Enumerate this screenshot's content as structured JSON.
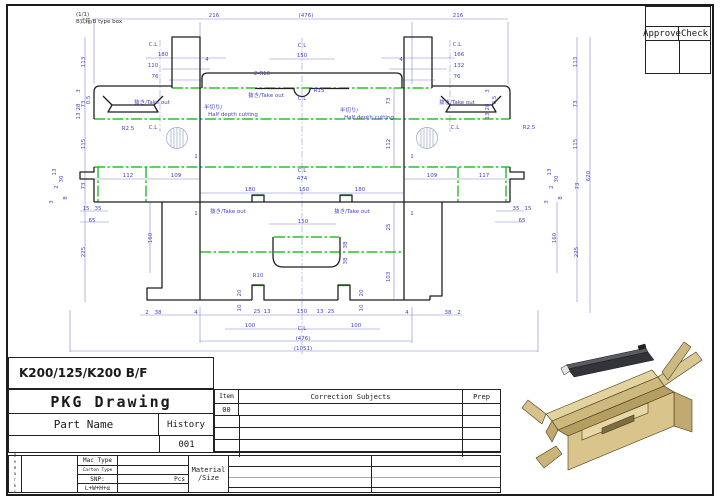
{
  "sheet": {
    "page_note": "(1/1)",
    "box_type": "B式箱/B type box",
    "part_label": "K200/125/K200 B/F"
  },
  "approval": {
    "approve": "Approve",
    "check": "Check"
  },
  "title_block": {
    "title": "PKG Drawing",
    "part_name": "Part Name",
    "history": "History",
    "history_no": "001",
    "item_label": "Item",
    "item_no": "00",
    "correction": "Correction Subjects",
    "prep": "Prep"
  },
  "spec_block": {
    "remarks": "Remarks",
    "mac_type": "Mac Type",
    "carton_type": "Carton Type",
    "snp": "SNP:",
    "pcs": "Pcs",
    "formula": "L+W+H+α",
    "material": "Material",
    "size": "/Size"
  },
  "colors": {
    "dimension": "#4545c8",
    "crease": "#00b400",
    "cut": "#1f1f1f",
    "carton": "#d9c48c"
  },
  "drawing": {
    "dims": [
      {
        "t": "(1/1)",
        "x": 76,
        "y": 16,
        "a": "s",
        "c": "k"
      },
      {
        "t": "B式箱/B type box",
        "x": 76,
        "y": 23,
        "a": "s",
        "c": "k"
      },
      {
        "t": "216",
        "x": 214,
        "y": 17
      },
      {
        "t": "(476)",
        "x": 306,
        "y": 17
      },
      {
        "t": "216",
        "x": 458,
        "y": 17
      },
      {
        "t": "C.L",
        "x": 153,
        "y": 46
      },
      {
        "t": "180",
        "x": 163,
        "y": 56
      },
      {
        "t": "110",
        "x": 153,
        "y": 67
      },
      {
        "t": "76",
        "x": 155,
        "y": 78
      },
      {
        "t": "4",
        "x": 207,
        "y": 61
      },
      {
        "t": "C.L",
        "x": 457,
        "y": 46
      },
      {
        "t": "166",
        "x": 459,
        "y": 56
      },
      {
        "t": "132",
        "x": 459,
        "y": 67
      },
      {
        "t": "76",
        "x": 457,
        "y": 78
      },
      {
        "t": "4",
        "x": 401,
        "y": 61
      },
      {
        "t": "C.L",
        "x": 302,
        "y": 47
      },
      {
        "t": "150",
        "x": 302,
        "y": 57
      },
      {
        "t": "2-R10",
        "x": 262,
        "y": 75
      },
      {
        "t": "R15",
        "x": 319,
        "y": 92
      },
      {
        "t": "C.L",
        "x": 302,
        "y": 100
      },
      {
        "t": "抜き/Take out",
        "x": 152,
        "y": 104
      },
      {
        "t": "抜き/Take out",
        "x": 266,
        "y": 97
      },
      {
        "t": "抜き/Take out",
        "x": 457,
        "y": 104
      },
      {
        "t": "半切り/",
        "x": 213,
        "y": 109
      },
      {
        "t": "Half depth cutting",
        "x": 233,
        "y": 116
      },
      {
        "t": "半切り/",
        "x": 349,
        "y": 112
      },
      {
        "t": "Half depth cutting",
        "x": 369,
        "y": 119
      },
      {
        "t": "R2.5",
        "x": 128,
        "y": 130
      },
      {
        "t": "C.L",
        "x": 153,
        "y": 129
      },
      {
        "t": "C.L",
        "x": 455,
        "y": 129
      },
      {
        "t": "R2.5",
        "x": 529,
        "y": 129
      },
      {
        "t": "3",
        "x": 80,
        "y": 91,
        "r": 1
      },
      {
        "t": "0.5",
        "x": 90,
        "y": 100,
        "r": 1
      },
      {
        "t": "28",
        "x": 80,
        "y": 107,
        "r": 1
      },
      {
        "t": "13",
        "x": 80,
        "y": 116,
        "r": 1
      },
      {
        "t": "3",
        "x": 489,
        "y": 91,
        "r": 1
      },
      {
        "t": "0.5",
        "x": 496,
        "y": 100,
        "r": 1
      },
      {
        "t": "28",
        "x": 489,
        "y": 107,
        "r": 1
      },
      {
        "t": "13",
        "x": 489,
        "y": 116,
        "r": 1
      },
      {
        "t": "113",
        "x": 85,
        "y": 62,
        "r": 1
      },
      {
        "t": "73",
        "x": 85,
        "y": 104,
        "r": 1
      },
      {
        "t": "115",
        "x": 85,
        "y": 144,
        "r": 1
      },
      {
        "t": "73",
        "x": 85,
        "y": 186,
        "r": 1
      },
      {
        "t": "225",
        "x": 85,
        "y": 252,
        "r": 1
      },
      {
        "t": "113",
        "x": 577,
        "y": 62,
        "r": 1
      },
      {
        "t": "73",
        "x": 577,
        "y": 104,
        "r": 1
      },
      {
        "t": "115",
        "x": 577,
        "y": 144,
        "r": 1
      },
      {
        "t": "73",
        "x": 579,
        "y": 186,
        "r": 1
      },
      {
        "t": "225",
        "x": 578,
        "y": 252,
        "r": 1
      },
      {
        "t": "620",
        "x": 590,
        "y": 176,
        "r": 1
      },
      {
        "t": "112",
        "x": 128,
        "y": 177
      },
      {
        "t": "109",
        "x": 176,
        "y": 177
      },
      {
        "t": "C.L",
        "x": 302,
        "y": 172
      },
      {
        "t": "474",
        "x": 302,
        "y": 180
      },
      {
        "t": "109",
        "x": 432,
        "y": 177
      },
      {
        "t": "117",
        "x": 484,
        "y": 177
      },
      {
        "t": "180",
        "x": 250,
        "y": 191
      },
      {
        "t": "150",
        "x": 304,
        "y": 191
      },
      {
        "t": "180",
        "x": 360,
        "y": 191
      },
      {
        "t": "1",
        "x": 196,
        "y": 158
      },
      {
        "t": "1",
        "x": 412,
        "y": 158
      },
      {
        "t": "1",
        "x": 196,
        "y": 215
      },
      {
        "t": "1",
        "x": 412,
        "y": 215
      },
      {
        "t": "73",
        "x": 390,
        "y": 101,
        "r": 1
      },
      {
        "t": "112",
        "x": 390,
        "y": 144,
        "r": 1
      },
      {
        "t": "25",
        "x": 390,
        "y": 227,
        "r": 1
      },
      {
        "t": "103",
        "x": 390,
        "y": 277,
        "r": 1
      },
      {
        "t": "抜き/Take out",
        "x": 228,
        "y": 213
      },
      {
        "t": "抜き/Take out",
        "x": 352,
        "y": 213
      },
      {
        "t": "150",
        "x": 303,
        "y": 223
      },
      {
        "t": "R10",
        "x": 258,
        "y": 277
      },
      {
        "t": "38",
        "x": 347,
        "y": 245,
        "r": 1
      },
      {
        "t": "38",
        "x": 347,
        "y": 261,
        "r": 1
      },
      {
        "t": "15",
        "x": 86,
        "y": 210
      },
      {
        "t": "35",
        "x": 98,
        "y": 210
      },
      {
        "t": "65",
        "x": 92,
        "y": 222
      },
      {
        "t": "35",
        "x": 516,
        "y": 210
      },
      {
        "t": "15",
        "x": 528,
        "y": 210
      },
      {
        "t": "65",
        "x": 522,
        "y": 222
      },
      {
        "t": "160",
        "x": 152,
        "y": 238,
        "r": 1
      },
      {
        "t": "160",
        "x": 556,
        "y": 238,
        "r": 1
      },
      {
        "t": "13",
        "x": 56,
        "y": 172,
        "r": 1
      },
      {
        "t": "30",
        "x": 63,
        "y": 179,
        "r": 1
      },
      {
        "t": "2",
        "x": 58,
        "y": 187,
        "r": 1
      },
      {
        "t": "8",
        "x": 67,
        "y": 198,
        "r": 1
      },
      {
        "t": "3",
        "x": 53,
        "y": 202,
        "r": 1
      },
      {
        "t": "13",
        "x": 551,
        "y": 172,
        "r": 1
      },
      {
        "t": "30",
        "x": 558,
        "y": 179,
        "r": 1
      },
      {
        "t": "2",
        "x": 553,
        "y": 187,
        "r": 1
      },
      {
        "t": "8",
        "x": 562,
        "y": 198,
        "r": 1
      },
      {
        "t": "3",
        "x": 548,
        "y": 202,
        "r": 1
      },
      {
        "t": "2",
        "x": 147,
        "y": 314
      },
      {
        "t": "38",
        "x": 158,
        "y": 314
      },
      {
        "t": "4",
        "x": 196,
        "y": 314
      },
      {
        "t": "25",
        "x": 257,
        "y": 313
      },
      {
        "t": "13",
        "x": 267,
        "y": 313
      },
      {
        "t": "150",
        "x": 302,
        "y": 313
      },
      {
        "t": "13",
        "x": 320,
        "y": 313
      },
      {
        "t": "25",
        "x": 331,
        "y": 313
      },
      {
        "t": "4",
        "x": 407,
        "y": 314
      },
      {
        "t": "38",
        "x": 448,
        "y": 314
      },
      {
        "t": "2",
        "x": 459,
        "y": 314
      },
      {
        "t": "20",
        "x": 241,
        "y": 293,
        "r": 1
      },
      {
        "t": "10",
        "x": 241,
        "y": 308,
        "r": 1
      },
      {
        "t": "20",
        "x": 363,
        "y": 293,
        "r": 1
      },
      {
        "t": "10",
        "x": 363,
        "y": 308,
        "r": 1
      },
      {
        "t": "100",
        "x": 250,
        "y": 327
      },
      {
        "t": "C.L",
        "x": 302,
        "y": 330
      },
      {
        "t": "100",
        "x": 356,
        "y": 327
      },
      {
        "t": "(476)",
        "x": 303,
        "y": 340
      },
      {
        "t": "(1051)",
        "x": 303,
        "y": 350
      }
    ]
  }
}
